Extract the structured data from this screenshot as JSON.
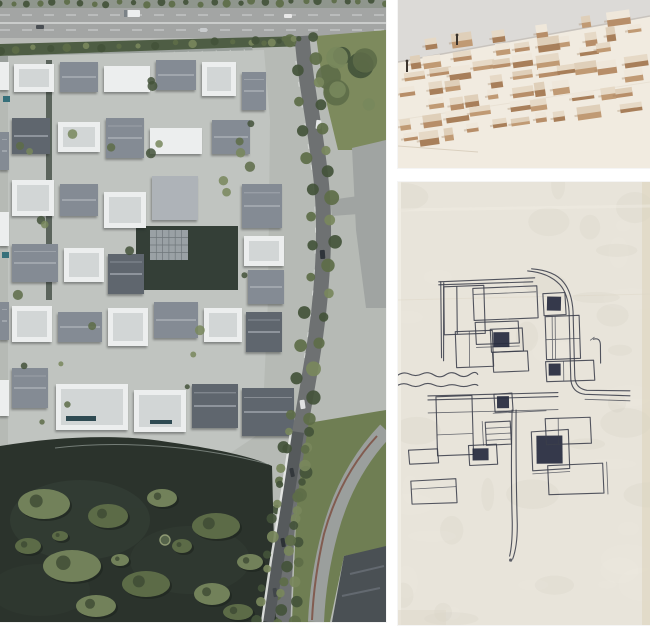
{
  "canvas": {
    "width": 650,
    "height": 629
  },
  "collage": {
    "panels": {
      "aerial": {
        "type": "aerial-photograph",
        "subject": "courtyard housing complex beside a lake, highway on top, tree-lined curving roads on the right, dark lake with planted islands at bottom left"
      },
      "model": {
        "type": "wood-massing-model-photograph",
        "subject": "rows of small rectangular wooden blocks on a pale baseboard, photographed at a low angle"
      },
      "sketch": {
        "type": "ink-plan-sketch",
        "subject": "hand-drawn plan of nested rectangles with dark filled squares, a curving road line on the right and a wavy shoreline on the left, on cream paper"
      }
    }
  },
  "colors": {
    "gutter": "#ffffff",
    "aerial_pavement": "#b6bab5",
    "aerial_complex_paving": "#c0c4c0",
    "aerial_highway": "#a3a5a4",
    "aerial_sidewalk": "#b9bbb8",
    "aerial_hedge": "#4e5d44",
    "aerial_parking": "#9aa09c",
    "aerial_road": "#6e7172",
    "aerial_light_road": "#a0a4a2",
    "aerial_arc_road": "#9b9f9d",
    "aerial_avenue": "#565a5c",
    "aerial_grass": "#6f7e53",
    "aerial_park": "#7d8a5d",
    "aerial_tree_dark": "#43523a",
    "aerial_tree_mid": "#5d6c48",
    "aerial_tree_light": "#78875c",
    "aerial_lake": "#2b332c",
    "aerial_pond": "#343f37",
    "aerial_island": "#5c6b47",
    "aerial_island_light": "#72815a",
    "roof_white": "#eceeee",
    "roof_white_inner": "#ccd0d0",
    "roof_gray": "#848b94",
    "roof_dark": "#5f666e",
    "roof_light": "#aeb3b8",
    "ridge_light": "#b9bec4",
    "pool_teal": "#36707a",
    "alley": "#49534a",
    "dark_corner": "#4a5054",
    "bike_strip": "#7e5043",
    "model_bg": "#dcdad7",
    "model_base": "#f1ebe0",
    "block_top_a": "#efe7da",
    "block_top_b": "#e6d9c6",
    "block_top_c": "#dfcfb9",
    "block_side_a": "#b78e69",
    "block_side_b": "#a87f5a",
    "block_side_c": "#c09a74",
    "pin_dark": "#3a332c",
    "sketch_paper": "#e8e4da",
    "sketch_ink": "#3b3f4b",
    "sketch_fill": "#272c40",
    "sketch_edge": "#ddd3bc"
  }
}
